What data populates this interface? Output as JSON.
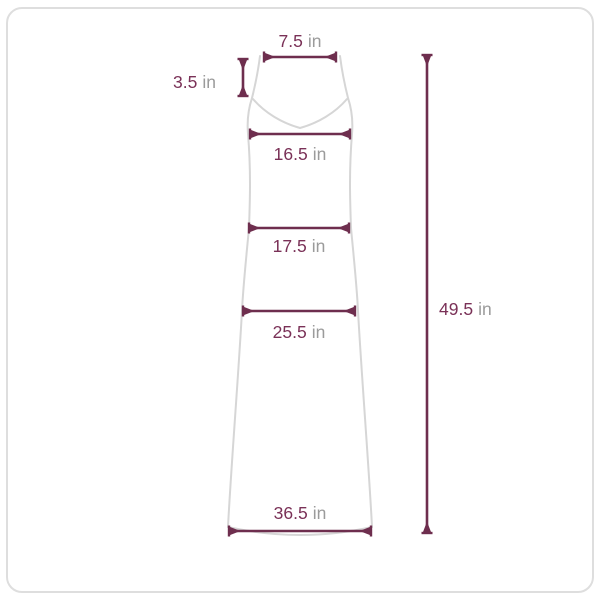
{
  "measurements": {
    "shoulder_width": {
      "value": "7.5",
      "unit": "in"
    },
    "strap_drop": {
      "value": "3.5",
      "unit": "in"
    },
    "bust": {
      "value": "16.5",
      "unit": "in"
    },
    "waist": {
      "value": "17.5",
      "unit": "in"
    },
    "hip": {
      "value": "25.5",
      "unit": "in"
    },
    "hem_width": {
      "value": "36.5",
      "unit": "in"
    },
    "length": {
      "value": "49.5",
      "unit": "in"
    }
  },
  "colors": {
    "accent_line": "#6e2e4e",
    "accent_text": "#7a3157",
    "unit_text": "#9b9b9b",
    "garment_outline": "#d6d6d6",
    "frame_border": "#dedede"
  }
}
